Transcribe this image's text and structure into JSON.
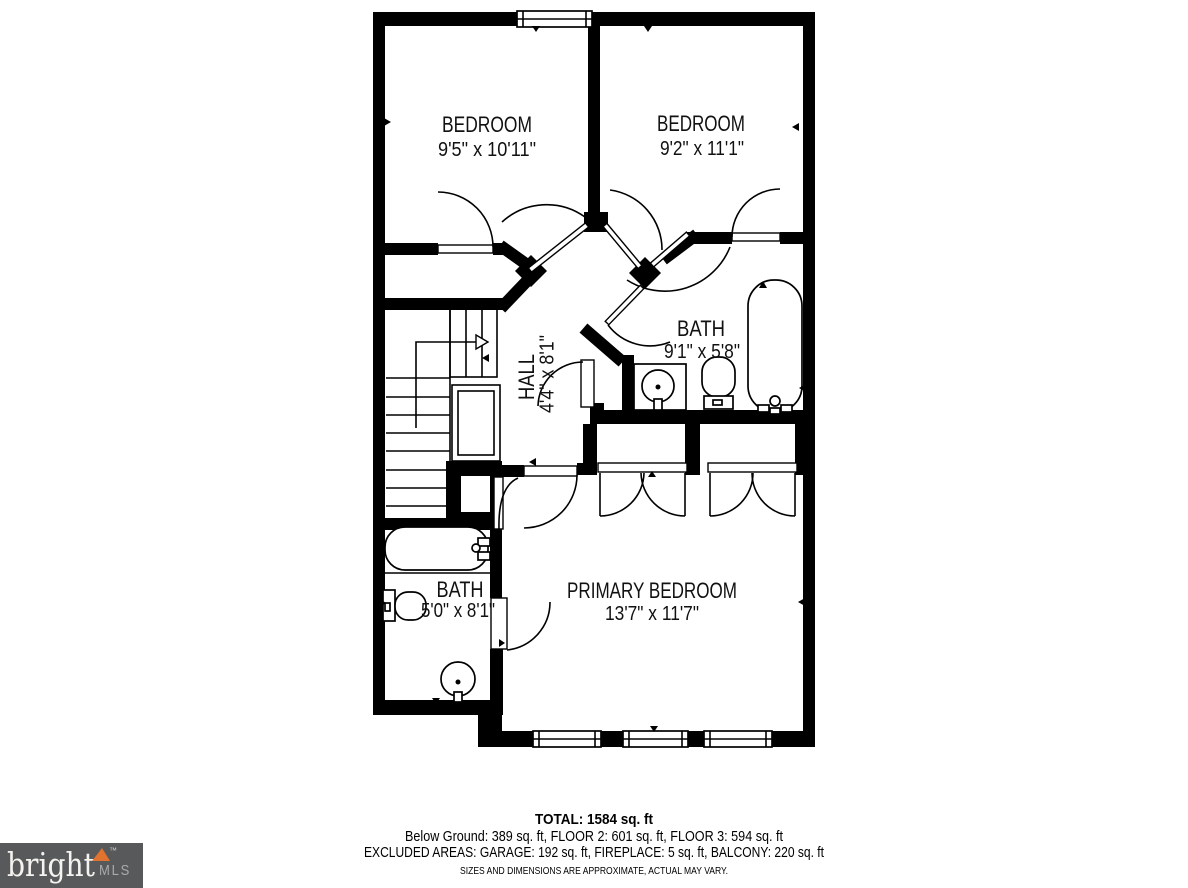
{
  "floor_plan": {
    "rooms": [
      {
        "id": "bedroom-1",
        "name": "BEDROOM",
        "dimensions": "9'5\" x 10'11\""
      },
      {
        "id": "bedroom-2",
        "name": "BEDROOM",
        "dimensions": "9'2\" x 11'1\""
      },
      {
        "id": "bath-upper",
        "name": "BATH",
        "dimensions": "9'1\" x 5'8\""
      },
      {
        "id": "hall",
        "name": "HALL",
        "dimensions": "4'4\" x 8'1\""
      },
      {
        "id": "bath-primary",
        "name": "BATH",
        "dimensions": "5'0\" x 8'1\""
      },
      {
        "id": "primary-bedroom",
        "name": "PRIMARY BEDROOM",
        "dimensions": "13'7\" x 11'7\""
      }
    ]
  },
  "footer": {
    "total": "TOTAL: 1584 sq. ft",
    "floors": "Below Ground: 389 sq. ft, FLOOR 2: 601 sq. ft, FLOOR 3: 594 sq. ft",
    "excluded": "EXCLUDED AREAS: GARAGE: 192 sq. ft, FIREPLACE: 5 sq. ft, BALCONY: 220 sq. ft",
    "disclaimer": "SIZES AND DIMENSIONS ARE APPROXIMATE, ACTUAL MAY VARY."
  },
  "logo": {
    "brand": "bright",
    "trademark": "™",
    "suffix": "MLS",
    "box_color": "#58595B",
    "brand_color": "#F5F3EF",
    "suffix_color": "#A8AAAD",
    "accent_color": "#E07330",
    "trademark_color": "#CFCFCD"
  },
  "colors": {
    "walls": "#000000",
    "background": "#FFFFFF",
    "label_text": "#1A1A1A"
  }
}
